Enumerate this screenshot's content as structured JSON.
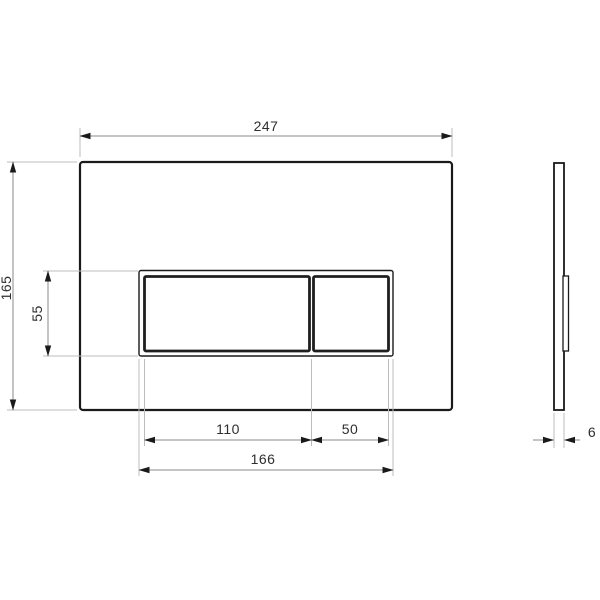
{
  "drawing": {
    "type": "technical-drawing",
    "subject": "wc-flush-plate",
    "views": {
      "front": {
        "label": "front view"
      },
      "side": {
        "label": "side view"
      }
    },
    "colors": {
      "outline": "#1a1a1a",
      "dimension_line": "#8a8a8a",
      "extension_line": "#bcbcbc",
      "text": "#2e2e2e",
      "background": "#ffffff"
    },
    "dimensions": {
      "overall_width": "247",
      "overall_height": "165",
      "button_panel_height": "55",
      "large_button_width": "110",
      "small_button_width": "50",
      "button_panel_width": "166",
      "plate_thickness": "6"
    }
  }
}
